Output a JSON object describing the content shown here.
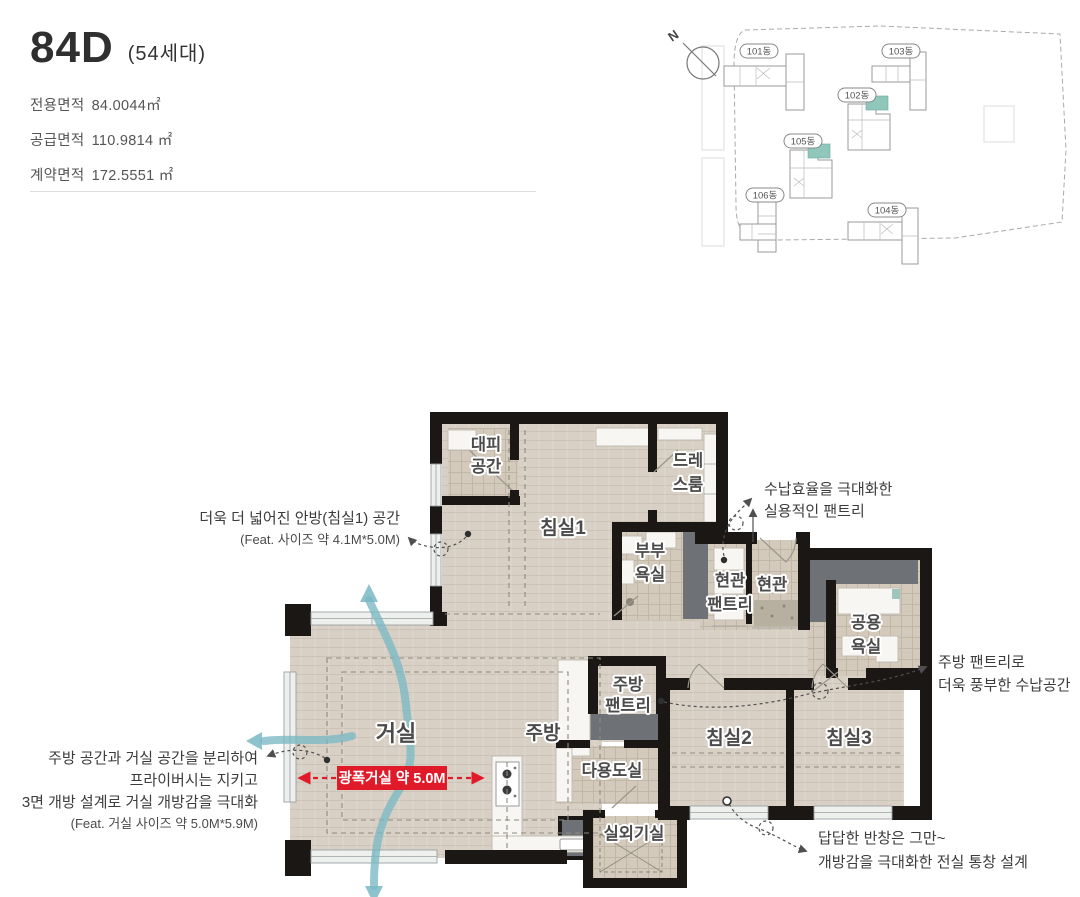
{
  "header": {
    "unit_type": "84D",
    "household_count": "(54세대)",
    "areas": [
      {
        "label": "전용면적",
        "value": "84.0044㎡"
      },
      {
        "label": "공급면적",
        "value": "110.9814 ㎡"
      },
      {
        "label": "계약면적",
        "value": "172.5551 ㎡"
      }
    ]
  },
  "site_map": {
    "compass": "N",
    "buildings": [
      {
        "label": "101동",
        "highlight": false
      },
      {
        "label": "102동",
        "highlight": true
      },
      {
        "label": "103동",
        "highlight": false
      },
      {
        "label": "104동",
        "highlight": false
      },
      {
        "label": "105동",
        "highlight": true
      },
      {
        "label": "106동",
        "highlight": false
      }
    ]
  },
  "floorplan": {
    "rooms": {
      "refuge": [
        "대피",
        "공간"
      ],
      "bedroom1": "침실1",
      "dressroom": [
        "드레",
        "스룸"
      ],
      "master_bath": [
        "부부",
        "욕실"
      ],
      "entry_pantry": [
        "현관",
        "팬트리"
      ],
      "entry": "현관",
      "common_bath": [
        "공용",
        "욕실"
      ],
      "living": "거실",
      "kitchen": "주방",
      "kitchen_pantry": [
        "주방",
        "팬트리"
      ],
      "utility": "다용도실",
      "bedroom2": "침실2",
      "bedroom3": "침실3",
      "outdoor_unit": "실외기실"
    },
    "badge": {
      "text": "광폭거실 약 5.0M",
      "color": "#e01a28"
    },
    "annotations": [
      {
        "id": "bedroom1-size",
        "lines": [
          "더욱 더 넓어진 안방(침실1) 공간",
          "(Feat. 사이즈 약 4.1M*5.0M)"
        ]
      },
      {
        "id": "entry-pantry",
        "lines": [
          "수납효율을 극대화한",
          "실용적인 팬트리"
        ]
      },
      {
        "id": "kitchen-pantry",
        "lines": [
          "주방 팬트리로",
          "더욱 풍부한 수납공간"
        ]
      },
      {
        "id": "living-open",
        "lines": [
          "주방 공간과 거실 공간을 분리하여",
          "프라이버시는 지키고",
          "3면 개방 설계로 거실 개방감을 극대화",
          "(Feat. 거실 사이즈 약 5.0M*5.9M)"
        ]
      },
      {
        "id": "full-window",
        "lines": [
          "답답한 반창은 그만~",
          "개방감을 극대화한 전실 통창 설계"
        ]
      }
    ]
  },
  "colors": {
    "accent_red": "#e01a28",
    "flow_teal": "#7ab9c4",
    "site_highlight": "#8fc8bb",
    "wall": "#1a1714"
  }
}
